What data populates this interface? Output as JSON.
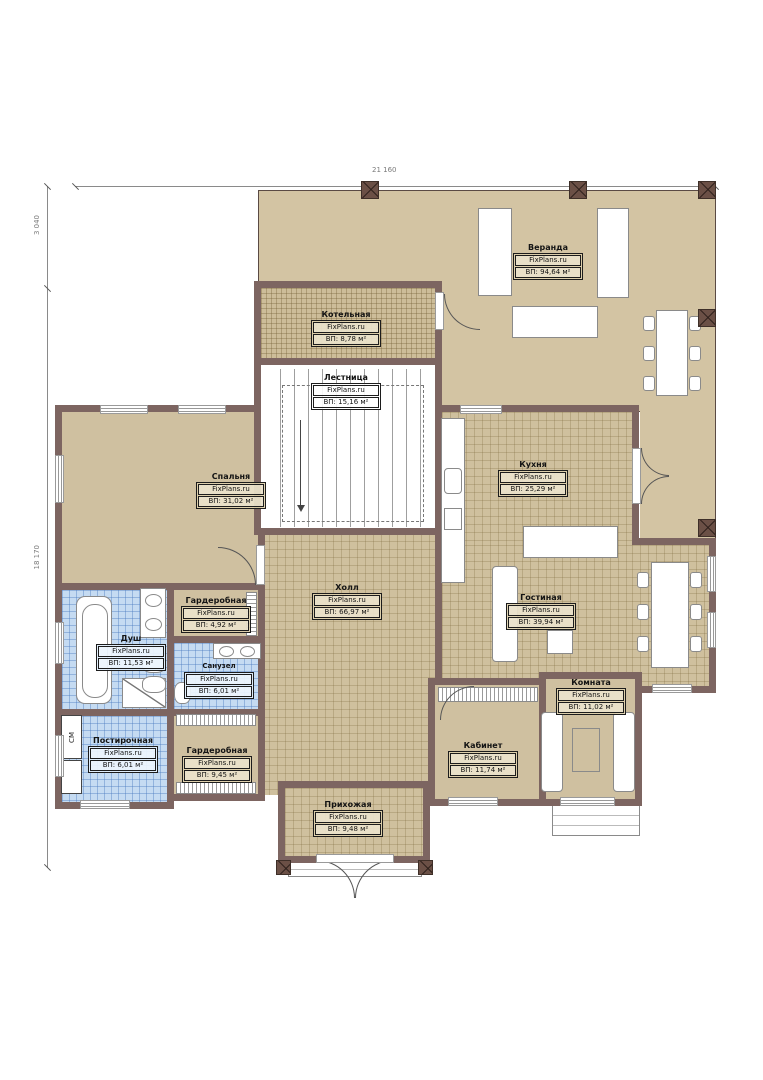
{
  "brand": "FixPlans.ru",
  "dimensions": {
    "top_width": "21 160",
    "left_upper": "3 040",
    "left_lower": "18 170"
  },
  "appliance_label": "СМ",
  "rooms": {
    "veranda": {
      "name": "Веранда",
      "area": "ВП: 94,64 м²"
    },
    "kotelnaya": {
      "name": "Котельная",
      "area": "ВП: 8,78 м²"
    },
    "lestnitsa": {
      "name": "Лестница",
      "area": "ВП: 15,16 м²"
    },
    "spalnya": {
      "name": "Спальня",
      "area": "ВП: 31,02 м²"
    },
    "kuhnya": {
      "name": "Кухня",
      "area": "ВП: 25,29 м²"
    },
    "holl": {
      "name": "Холл",
      "area": "ВП: 66,97 м²"
    },
    "gostinaya": {
      "name": "Гостиная",
      "area": "ВП: 39,94 м²"
    },
    "garderobnaya_1": {
      "name": "Гардеробная",
      "area": "ВП: 4,92 м²"
    },
    "dush": {
      "name": "Душ",
      "area": "ВП: 11,53 м²"
    },
    "sanuzel": {
      "name": "Санузел",
      "area": "ВП: 6,01 м²"
    },
    "postirochnaya": {
      "name": "Постирочная",
      "area": "ВП: 6,01 м²"
    },
    "garderobnaya_2": {
      "name": "Гардеробная",
      "area": "ВП: 9,45 м²"
    },
    "prihozhaya": {
      "name": "Прихожая",
      "area": "ВП: 9,48 м²"
    },
    "kabinet": {
      "name": "Кабинет",
      "area": "ВП: 11,74 м²"
    },
    "komnata": {
      "name": "Комната",
      "area": "ВП: 11,02 м²"
    }
  }
}
